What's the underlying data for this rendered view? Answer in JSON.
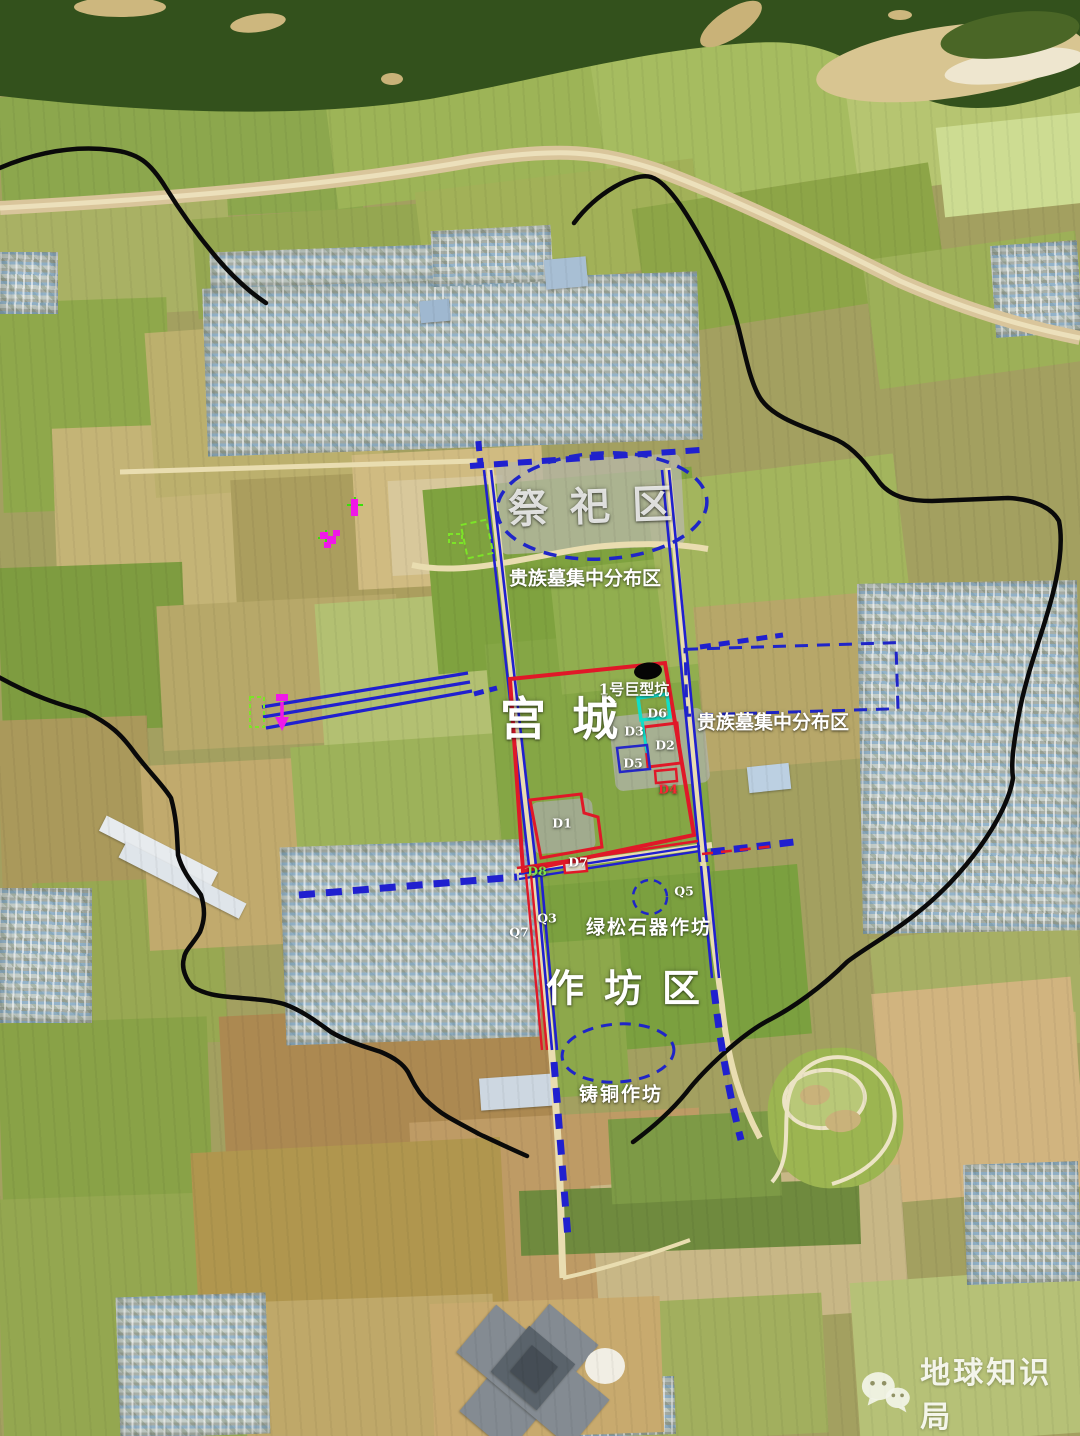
{
  "map": {
    "regions": {
      "sacrificial_area": "祭祀区",
      "noble_tombs_left": "贵族墓集中分布区",
      "noble_tombs_right": "贵族墓集中分布区",
      "palace_city": "宫城",
      "giant_pit": "1号巨型坑",
      "turquoise_workshop": "绿松石器作坊",
      "workshop_area": "作坊区",
      "bronze_workshop": "铸铜作坊"
    },
    "site_markers": {
      "d1": "D1",
      "d2": "D2",
      "d3": "D3",
      "d4": "D4",
      "d5": "D5",
      "d6": "D6",
      "d7": "D7",
      "d8": "D8",
      "q3": "Q3",
      "q5": "Q5",
      "q7": "Q7"
    },
    "colors": {
      "annotation_blue": "#1f25c8",
      "annotation_red": "#e01828",
      "annotation_cyan": "#12dec8",
      "annotation_magenta": "#f018e8",
      "annotation_green": "#7ce428",
      "boundary_black": "#0a0a0a",
      "label_white": "#ffffff"
    }
  },
  "watermark": {
    "brand": "地球知识局",
    "icon": "wechat-icon"
  }
}
